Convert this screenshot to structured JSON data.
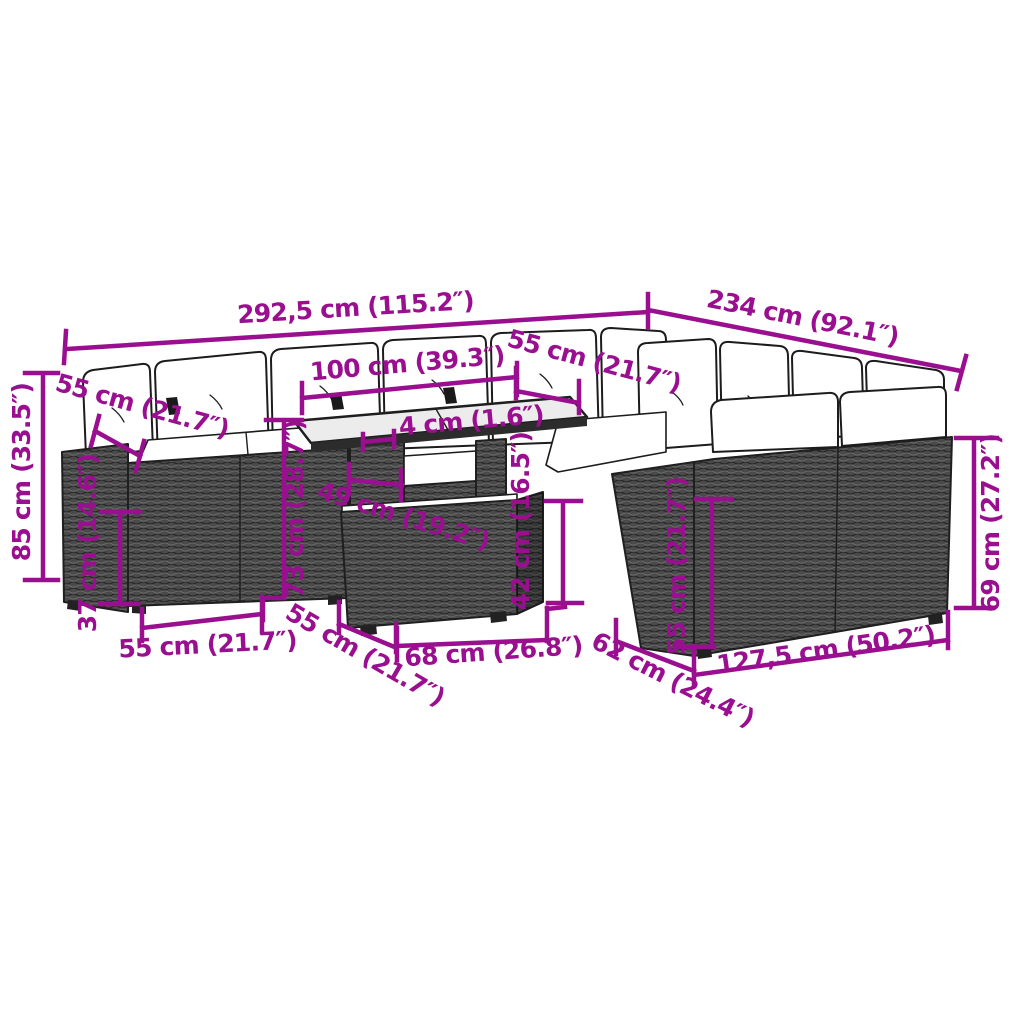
{
  "page": {
    "background": "#ffffff",
    "description": "Dimension diagram of an L-shaped poly-rattan garden lounge set with white cushions and a glass-top table"
  },
  "colors": {
    "dimension_annotation": "#9A0F8F",
    "wicker": "#4a4a4a",
    "outline": "#1c1c1c",
    "cushion": "#ffffff",
    "glass_top": "#ececec"
  },
  "dims": {
    "overall_width_left": {
      "label": "292,5 cm (115.2″)"
    },
    "overall_width_right": {
      "label": "234 cm (92.1″)"
    },
    "table_width": {
      "label": "100 cm (39.3″)"
    },
    "glass_thickness": {
      "label": "4 cm (1.6″)"
    },
    "back_seat_depth_left": {
      "label": "55 cm (21.7″)"
    },
    "back_seat_depth_right": {
      "label": "55 cm (21.7″)"
    },
    "overall_height": {
      "label": "85 cm (33.5″)"
    },
    "seat_height": {
      "label": "37 cm (14.6″)"
    },
    "table_height": {
      "label": "73 cm (28.7″)"
    },
    "table_top_depth": {
      "label": "49 cm (19.2″)"
    },
    "table_shelf_height": {
      "label": "42 cm (16.5″)"
    },
    "seat_width_left": {
      "label": "55 cm (21.7″)"
    },
    "seat_width_middle": {
      "label": "55 cm (21.7″)"
    },
    "table_length": {
      "label": "68 cm (26.8″)"
    },
    "right_seat_depth": {
      "label": "62 cm (24.4″)"
    },
    "right_section_length": {
      "label": "127,5 cm (50.2″)"
    },
    "right_back_height": {
      "label": "55 cm (21.7″)"
    },
    "right_arm_height": {
      "label": "69 cm (27.2″)"
    }
  }
}
